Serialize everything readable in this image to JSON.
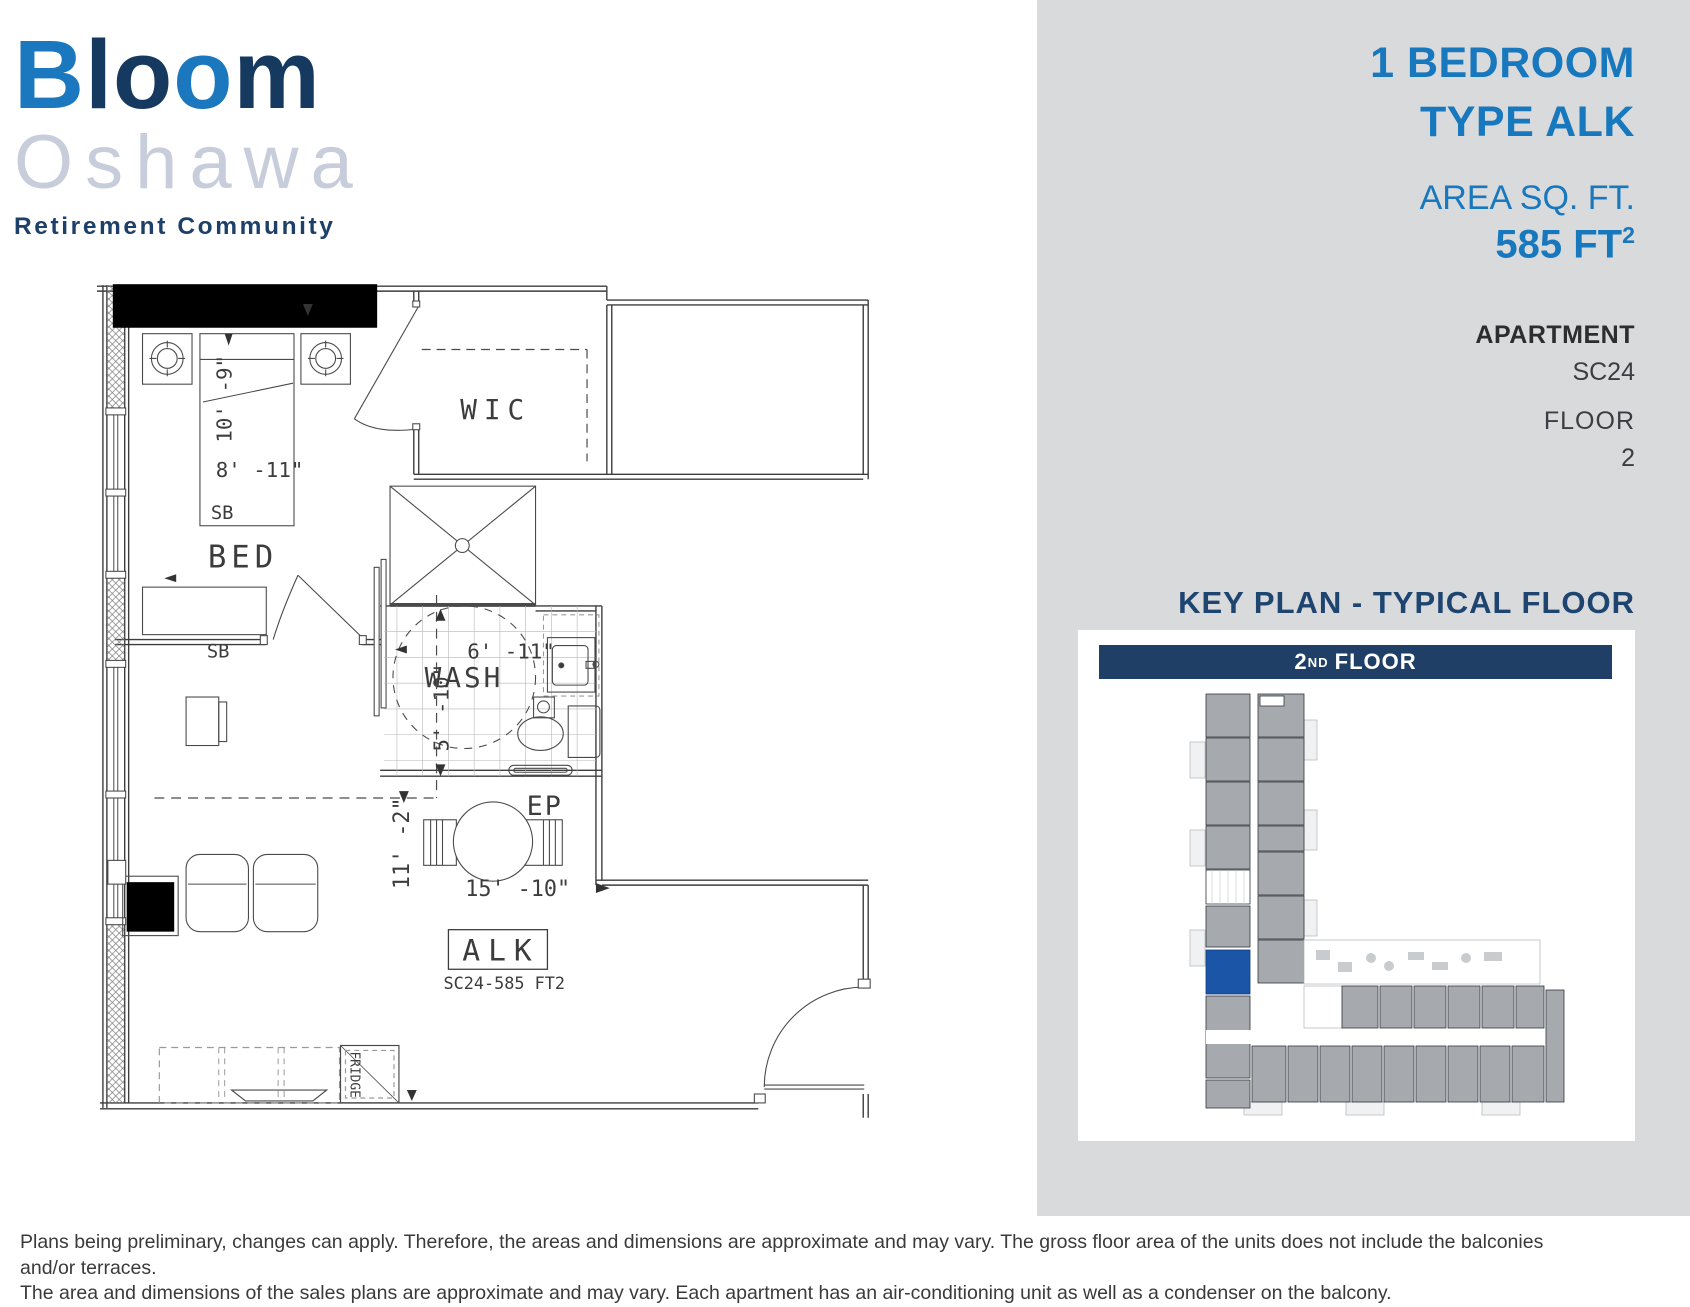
{
  "logo": {
    "b": "B",
    "l": "l",
    "o1": "o",
    "o2": "o",
    "m": "m",
    "city": "Oshawa",
    "tagline": "Retirement Community"
  },
  "panel": {
    "title_line1": "1 BEDROOM",
    "title_line2": "TYPE ALK",
    "area_label": "AREA SQ. FT.",
    "area_value": "585 FT",
    "area_sup": "2",
    "apartment_label": "APARTMENT",
    "apartment_number": "SC24",
    "floor_label": "FLOOR",
    "floor_number": "2",
    "key_plan_heading": "KEY PLAN - TYPICAL FLOOR",
    "floor_bar_number": "2",
    "floor_bar_sup": "ND",
    "floor_bar_text": "FLOOR"
  },
  "plan": {
    "labels": {
      "bed": "BED",
      "wic": "WIC",
      "wash": "WASH",
      "alk": "ALK",
      "ep": "EP",
      "sb_bed": "SB",
      "sb_living": "SB",
      "fridge": "FRIDGE",
      "unit_code": "SC24-585 FT2"
    },
    "dims": {
      "bed_width": "10' -9\"",
      "bed_length": "8' -11\"",
      "wash_width": "6' -11\"",
      "wash_depth": "5' -10\"",
      "living_width": "11' -2\"",
      "living_length": "15' -10\""
    }
  },
  "disclaimer": {
    "line1": "Plans being preliminary, changes can apply. Therefore, the areas and dimensions are approximate and may vary. The gross floor area of the units does not include the balconies and/or terraces.",
    "line2": "The area and dimensions of the sales plans are approximate and may vary. Each apartment has an air-conditioning unit as well as a condenser on the balcony."
  },
  "colors": {
    "accent_blue": "#1878be",
    "navy": "#1f3f66",
    "logo_light_blue": "#1b78be",
    "logo_navy": "#16395f",
    "logo_city_gray": "#c7cdda",
    "panel_gray": "#d9dadc",
    "keyplan_unit_gray": "#a6aaae",
    "highlight_unit_blue": "#1a55a8"
  }
}
